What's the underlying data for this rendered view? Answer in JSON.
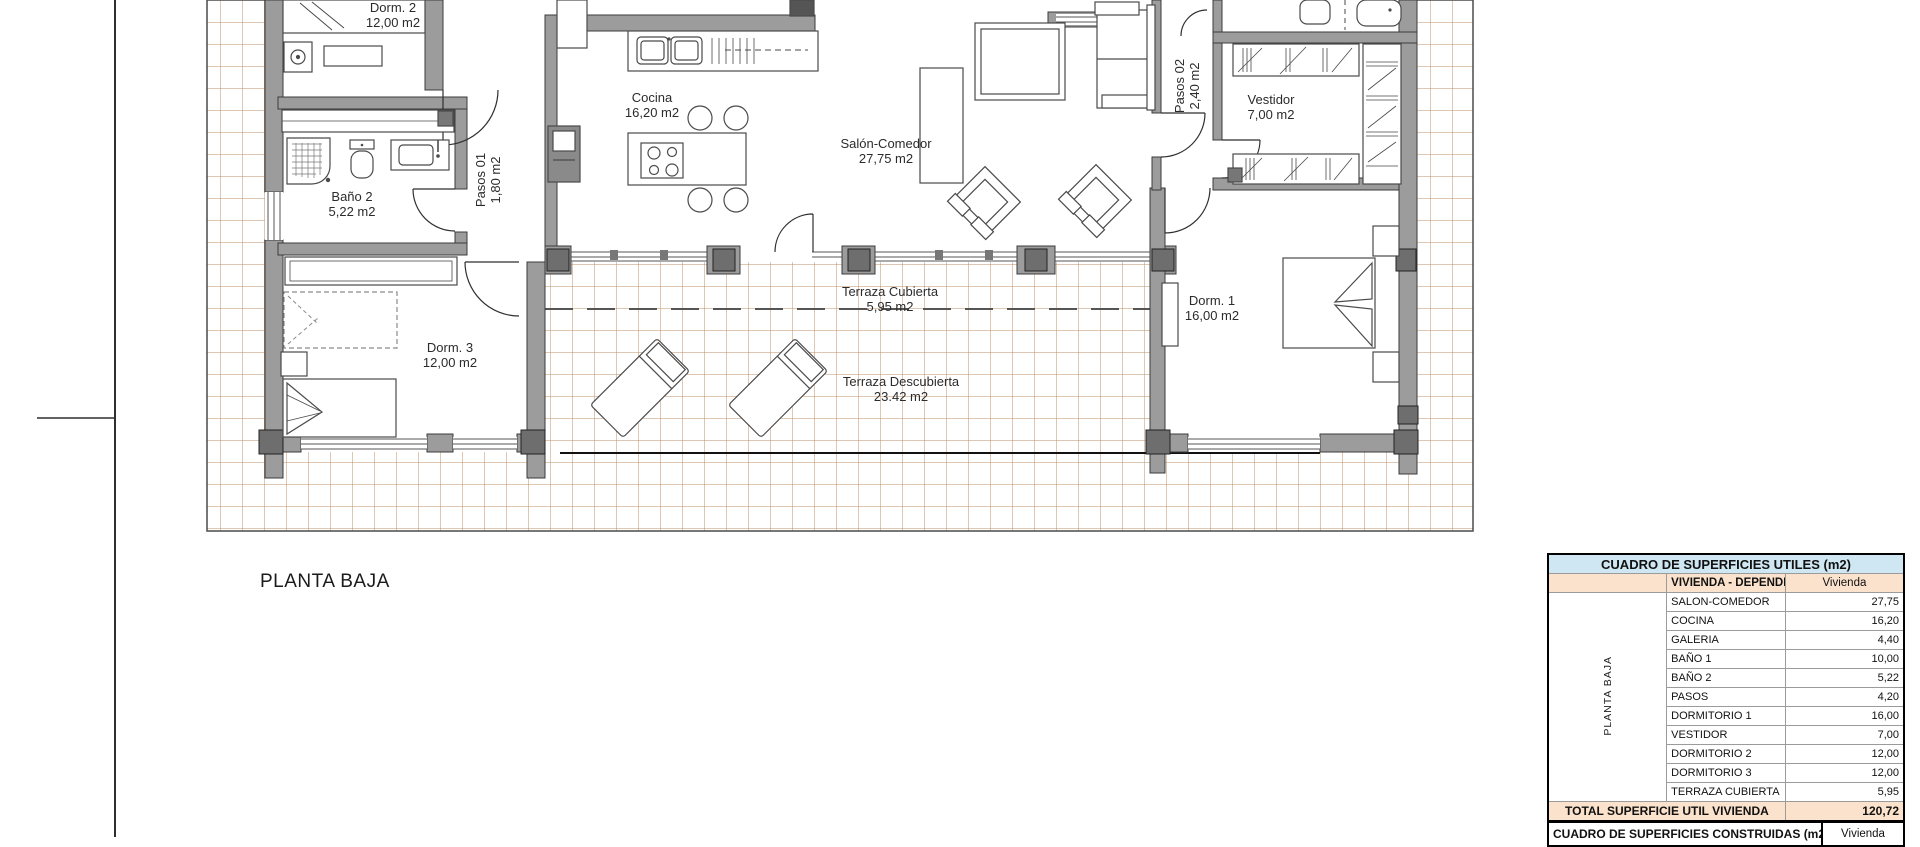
{
  "plan": {
    "caption": "PLANTA BAJA",
    "rooms": [
      {
        "id": "dorm2",
        "name": "Dorm. 2",
        "area": "12,00 m2"
      },
      {
        "id": "cocina",
        "name": "Cocina",
        "area": "16,20 m2"
      },
      {
        "id": "bano2",
        "name": "Baño 2",
        "area": "5,22 m2"
      },
      {
        "id": "pasos01",
        "name": "Pasos 01",
        "area": "1,80 m2"
      },
      {
        "id": "salon",
        "name": "Salón-Comedor",
        "area": "27,75 m2"
      },
      {
        "id": "pasos02",
        "name": "Pasos 02",
        "area": "2,40 m2"
      },
      {
        "id": "vestidor",
        "name": "Vestidor",
        "area": "7,00 m2"
      },
      {
        "id": "dorm1",
        "name": "Dorm. 1",
        "area": "16,00 m2"
      },
      {
        "id": "dorm3",
        "name": "Dorm. 3",
        "area": "12,00 m2"
      },
      {
        "id": "terraza_cubierta",
        "name": "Terraza Cubierta",
        "area": "5,95 m2"
      },
      {
        "id": "terraza_descubierta",
        "name": "Terraza Descubierta",
        "area": "23.42 m2"
      }
    ]
  },
  "surfaces_table": {
    "title": "CUADRO DE SUPERFICIES UTILES (m2)",
    "side_label": "PLANTA BAJA",
    "header": {
      "label": "VIVIENDA - DEPENDENCIAS",
      "value": "Vivienda"
    },
    "rows": [
      [
        "SALON-COMEDOR",
        "27,75"
      ],
      [
        "COCINA",
        "16,20"
      ],
      [
        "GALERIA",
        "4,40"
      ],
      [
        "BAÑO 1",
        "10,00"
      ],
      [
        "BAÑO 2",
        "5,22"
      ],
      [
        "PASOS",
        "4,20"
      ],
      [
        "DORMITORIO 1",
        "16,00"
      ],
      [
        "VESTIDOR",
        "7,00"
      ],
      [
        "DORMITORIO 2",
        "12,00"
      ],
      [
        "DORMITORIO 3",
        "12,00"
      ],
      [
        "TERRAZA CUBIERTA",
        "5,95"
      ]
    ],
    "total": {
      "label": "TOTAL SUPERFICIE UTIL VIVIENDA",
      "value": "120,72"
    }
  },
  "built_table": {
    "title": "CUADRO DE SUPERFICIES CONSTRUIDAS (m2)",
    "value_header": "Vivienda"
  },
  "colors": {
    "table_title_bg": "#cfe7f3",
    "table_accent_bg": "#fbe2cc",
    "wall_fill": "#9c9c9c",
    "pillar_fill": "#6e6e6e",
    "tile_line": "#bd9268"
  }
}
